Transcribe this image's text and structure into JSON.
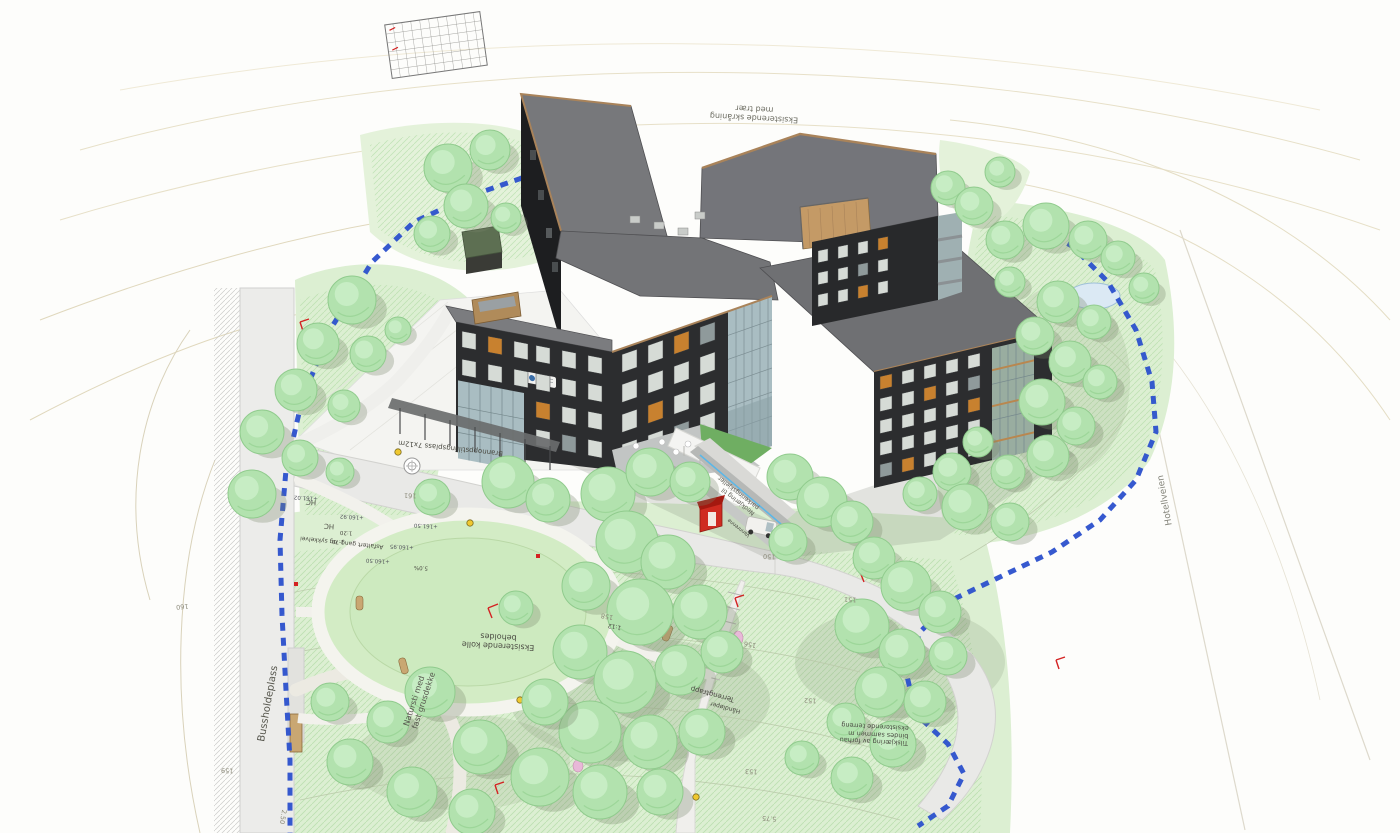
{
  "scene": {
    "type": "architectural-site-plan-3d",
    "description": "Aerial 3D illustration of a dark X-shaped care-home building on a landscaped site plan with trees, paths, bus stop and terrain annotations"
  },
  "annotations": {
    "slope_note_1": "Eksisterende skråning",
    "slope_note_2": "med trær",
    "fire_truck_area": "Brannoppstillingsplass 7x12m",
    "path_note": "Asfaltert gang- og sykkelvei",
    "hc_1": "HC",
    "hc_2": "HC",
    "bus_stop": "Bussholdeplass",
    "nature_trail_1": "Natursti med",
    "nature_trail_2": "fast grusdekke",
    "knoll_1": "Eksisterende kolle",
    "knoll_2": "beholdes",
    "terrain_stairs": "Terrengtrapp",
    "handrail": "Håndløper",
    "road_name": "Hotellveien",
    "ramp_1": "Nedkjøring til",
    "ramp_2": "parkeringskjeller",
    "water_channel": "Vannrenne",
    "cut_note_1": "Tilskjæring av forhau",
    "cut_note_2": "bindes sammen m",
    "cut_note_3": "eksisterende terreng",
    "slope_ratio_1": "1:12",
    "slope_ratio_2": "1:20",
    "dim_1": "1.70",
    "grade": "5.0%"
  },
  "elevations": [
    "+161.02",
    "+160.92",
    "+160.95",
    "+161.50",
    "+160.50"
  ],
  "contour_labels": [
    "161",
    "160",
    "159",
    "158",
    "156",
    "150",
    "151",
    "152",
    "153",
    "5.75",
    "2.50"
  ],
  "colors": {
    "building_wall": "#2c2d2f",
    "building_wall_shade": "#1d1e20",
    "roof_gray": "#737477",
    "wood_trim": "#a9835a",
    "glass": "#a9bdc2",
    "terrain_green": "#dcefd2",
    "tree_green": "#b2e2ae",
    "boundary_blue": "#2b50cc",
    "kiosk_red": "#cf2b20",
    "window_accent_orange": "#c8812f"
  }
}
